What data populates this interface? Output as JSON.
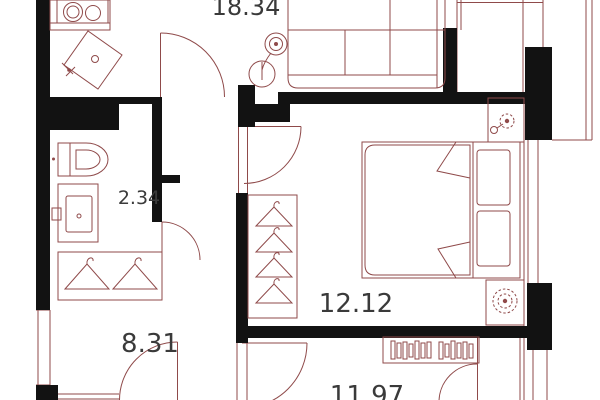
{
  "plan": {
    "type": "apartment-floor-plan",
    "colors": {
      "wall": "#121212",
      "line": "#8f4a4a",
      "label": "#3a3a3a",
      "bg": "#ffffff"
    },
    "rooms": [
      {
        "id": "living-kitchen",
        "area_label": "18.34"
      },
      {
        "id": "bathroom",
        "area_label": "2.34"
      },
      {
        "id": "hallway",
        "area_label": "8.31"
      },
      {
        "id": "bedroom",
        "area_label": "12.12"
      },
      {
        "id": "second-room",
        "area_label": "11.97"
      }
    ],
    "furniture": [
      "stove-two-burners",
      "kitchen-sink",
      "sofa",
      "floor-lamp",
      "toilet",
      "washbasin",
      "wardrobe-two-hangers",
      "closet-four-hangers",
      "double-bed-with-pillows",
      "plant-top",
      "plant-bottom",
      "bookshelf"
    ]
  }
}
